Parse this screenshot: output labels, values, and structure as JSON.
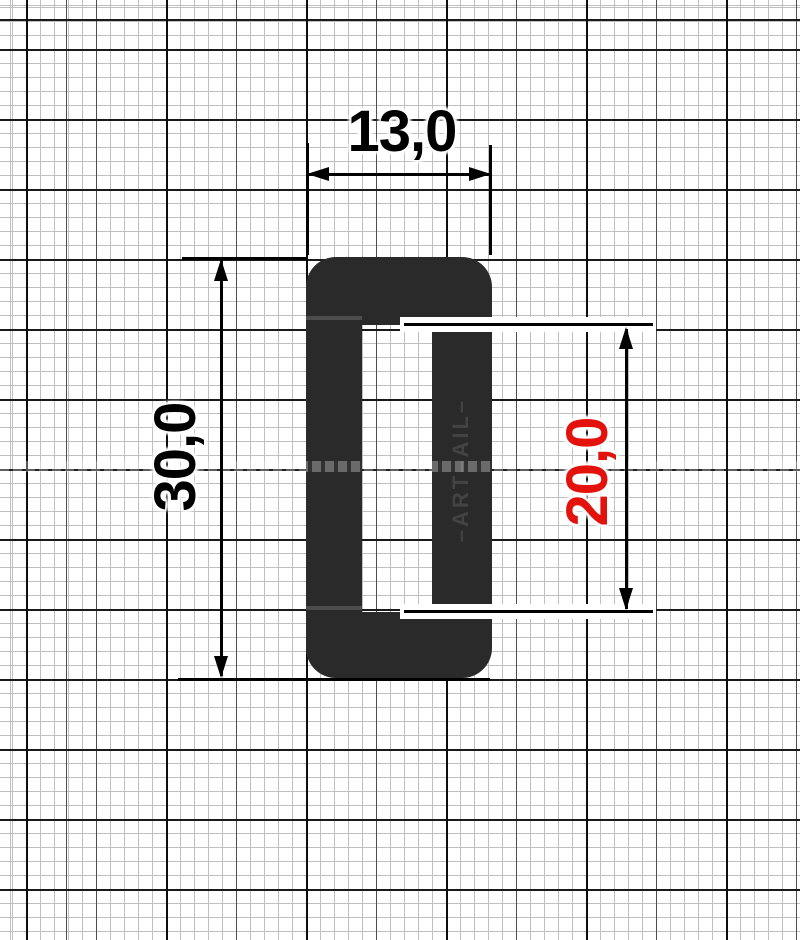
{
  "paper": {
    "style": "millimeter graph paper",
    "grid_fine_px": 14,
    "grid_major_px": 70
  },
  "part": {
    "name": "rectangular frame buckle",
    "color": "#2a2a2a",
    "embossed_text": "–ART–AIL–"
  },
  "dims": {
    "outer_width": {
      "label": "13,0",
      "color": "#000000",
      "orientation": "horizontal"
    },
    "outer_height": {
      "label": "30,0",
      "color": "#000000",
      "orientation": "vertical"
    },
    "inner_height": {
      "label": "20,0",
      "color": "#e3120d",
      "orientation": "vertical"
    }
  }
}
